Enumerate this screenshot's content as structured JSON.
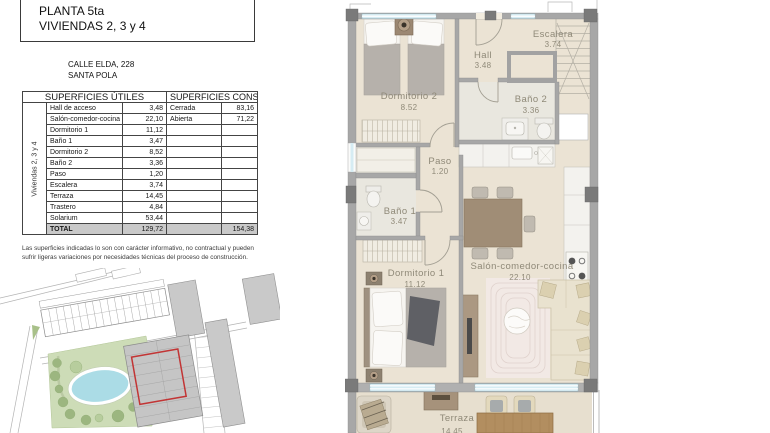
{
  "header": {
    "line1": "PLANTA 5ta",
    "line2": "VIVIENDAS 2, 3 y 4"
  },
  "address": {
    "line1": "CALLE ELDA, 228",
    "line2": "SANTA POLA"
  },
  "table": {
    "col_utiles": "SUPERFICIES ÚTILES",
    "col_construidas": "SUPERFICIES CONSTRUIDAS",
    "vertical_label": "Viviendas 2, 3 y 4",
    "rows": [
      {
        "name": "Hall de acceso",
        "value": "3,48",
        "clabel": "Cerrada",
        "cvalue": "83,16"
      },
      {
        "name": "Salón-comedor-cocina",
        "value": "22,10",
        "clabel": "Abierta",
        "cvalue": "71,22"
      },
      {
        "name": "Dormitorio 1",
        "value": "11,12",
        "clabel": "",
        "cvalue": ""
      },
      {
        "name": "Baño 1",
        "value": "3,47",
        "clabel": "",
        "cvalue": ""
      },
      {
        "name": "Dormitorio 2",
        "value": "8,52",
        "clabel": "",
        "cvalue": ""
      },
      {
        "name": "Baño 2",
        "value": "3,36",
        "clabel": "",
        "cvalue": ""
      },
      {
        "name": "Paso",
        "value": "1,20",
        "clabel": "",
        "cvalue": ""
      },
      {
        "name": "Escalera",
        "value": "3,74",
        "clabel": "",
        "cvalue": ""
      },
      {
        "name": "Terraza",
        "value": "14,45",
        "clabel": "",
        "cvalue": ""
      },
      {
        "name": "Trastero",
        "value": "4,84",
        "clabel": "",
        "cvalue": ""
      },
      {
        "name": "Solarium",
        "value": "53,44",
        "clabel": "",
        "cvalue": ""
      }
    ],
    "total": {
      "name": "TOTAL",
      "value": "129,72",
      "cvalue": "154,38"
    }
  },
  "disclaimer": "Las superficies indicadas lo son con carácter informativo, no contractual y pueden sufrir ligeras variaciones por necesidades técnicas del proceso de construcción.",
  "plan": {
    "rooms": [
      {
        "label": "Dormitorio 2",
        "area": "8.52"
      },
      {
        "label": "Hall",
        "area": "3.48"
      },
      {
        "label": "Escalera",
        "area": "3.74"
      },
      {
        "label": "Baño 2",
        "area": "3.36"
      },
      {
        "label": "Paso",
        "area": "1.20"
      },
      {
        "label": "Baño 1",
        "area": "3.47"
      },
      {
        "label": "Dormitorio 1",
        "area": "11.12"
      },
      {
        "label": "Salón-comedor-cocina",
        "area": "22.10"
      },
      {
        "label": "Terraza",
        "area": "14.45"
      }
    ]
  },
  "colors": {
    "accent_red": "#c23535",
    "pool_blue": "#abdce6",
    "park_green": "#cddcb7",
    "window_blue": "#d6ecf3",
    "wall_gray": "#a7a7a7",
    "floor_beige": "#ebe3d4",
    "total_row_gray": "#c9c9c9"
  }
}
